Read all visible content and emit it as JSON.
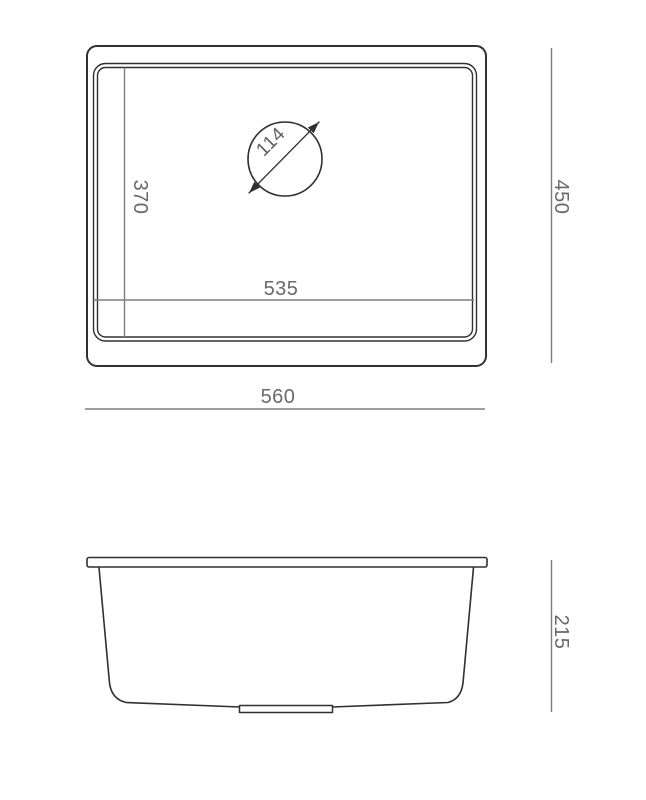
{
  "views": {
    "top": {
      "dims": {
        "overall_width": "560",
        "overall_depth": "450",
        "bowl_width": "535",
        "bowl_depth": "370",
        "drain_diameter": "114"
      }
    },
    "side": {
      "dims": {
        "height": "215"
      }
    }
  },
  "colors": {
    "background": "#ffffff",
    "outline": "#303030",
    "dimension_line": "#7d7d7d",
    "dimension_text": "#696969"
  }
}
